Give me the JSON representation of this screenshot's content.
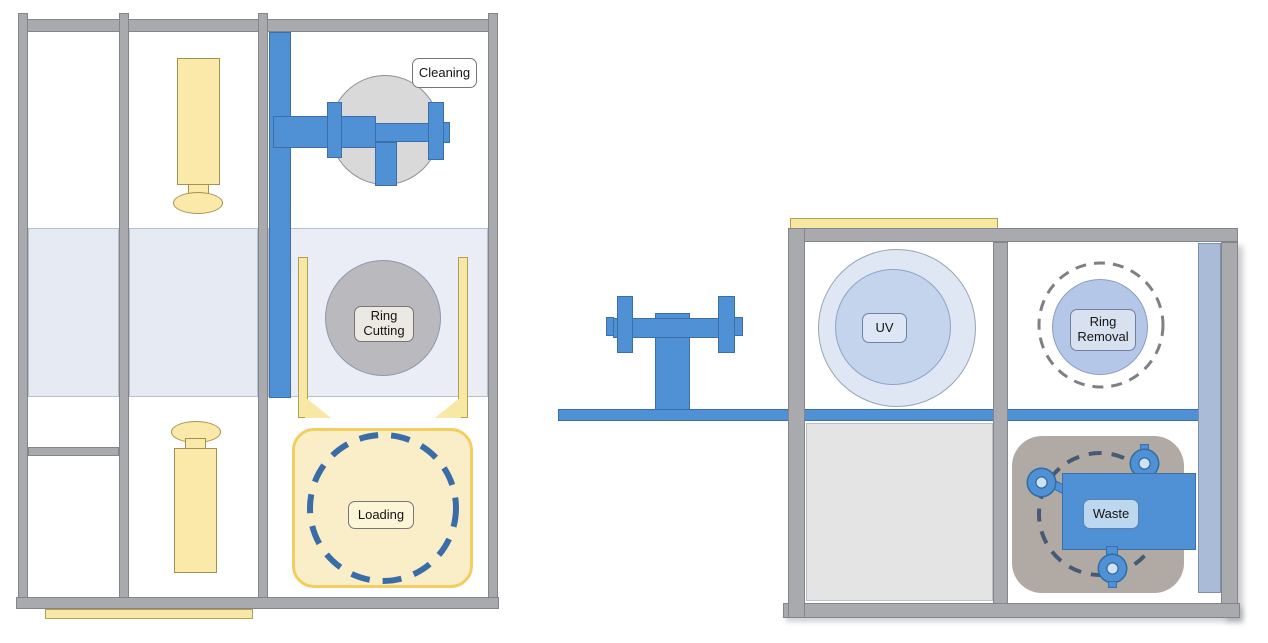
{
  "left_machine": {
    "stations": [
      {
        "id": "cleaning",
        "label": "Cleaning"
      },
      {
        "id": "ring-cutting",
        "label_line1": "Ring",
        "label_line2": "Cutting"
      },
      {
        "id": "loading",
        "label": "Loading"
      }
    ]
  },
  "right_machine": {
    "stations": [
      {
        "id": "uv",
        "label": "UV"
      },
      {
        "id": "ring-removal",
        "label_line1": "Ring",
        "label_line2": "Removal"
      },
      {
        "id": "waste",
        "label": "Waste"
      }
    ]
  },
  "colors": {
    "frame_gray": "#a9aaae",
    "mechanism_blue": "#4f91d4",
    "cylinder_yellow": "#fae9a8",
    "loading_pad_yellow": "#faeec8",
    "band_light_blue": "#e6eaf3",
    "cleaning_disc_gray": "#d9d9d9",
    "cutting_disc_gray": "#b9b9be",
    "uv_outer_blue": "#dfe7f5",
    "uv_inner_blue": "#c4d4ed",
    "ring_removal_blue": "#b5c7e8",
    "waste_pad_taupe": "#b1a9a3",
    "slate_panel_blue": "#a9bbd6",
    "dash_navy": "#3a6ca8",
    "dash_slate": "#475a74",
    "dash_gray": "#7f7f84"
  }
}
